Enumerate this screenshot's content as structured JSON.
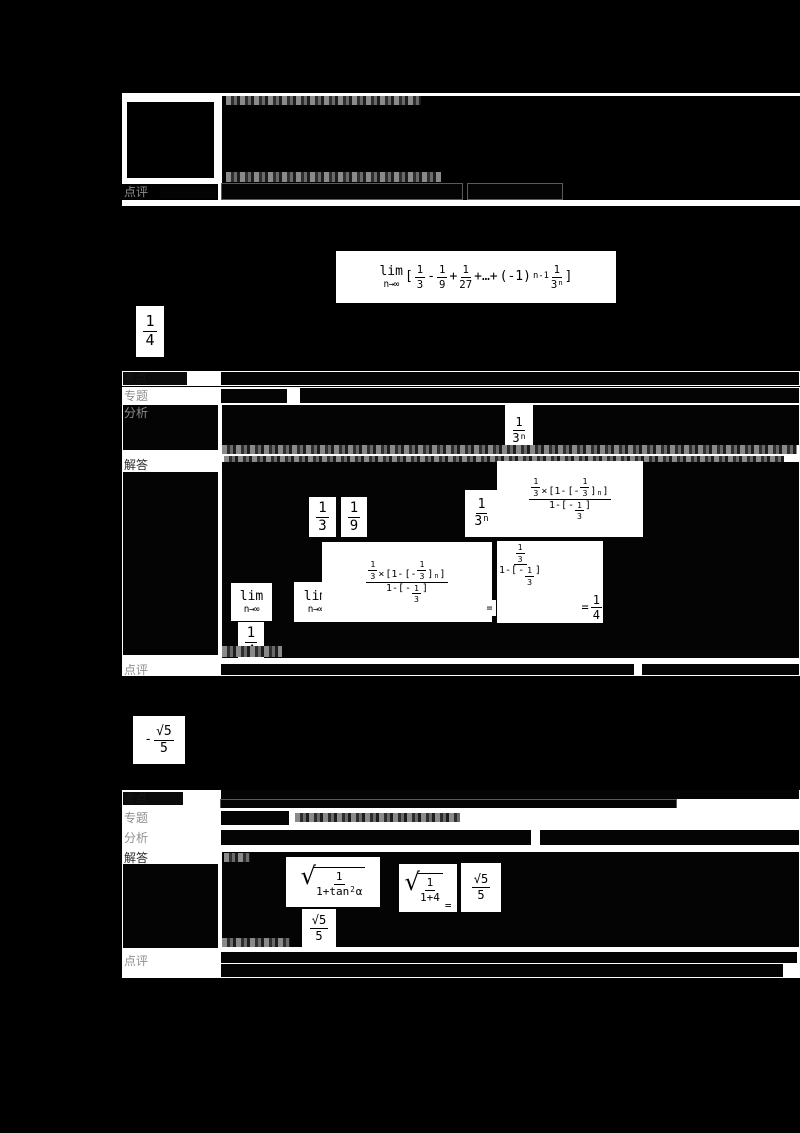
{
  "document": {
    "kind": "scanned Chinese math exam solution page",
    "colors": {
      "background": "#000000",
      "paper": "#ffffff",
      "ink": "#000000",
      "ghost_text": "#8a8a8a"
    }
  },
  "labels": {
    "kaodian": "考点",
    "zhuanti": "专题",
    "fenxi": "分析",
    "jieda": "解答",
    "dianping": "点评"
  },
  "tokens": {
    "lim": "lim",
    "lim_sub": "n→∞",
    "open": "[",
    "close": "]",
    "one": "1",
    "three": "3",
    "four": "4",
    "five": "5",
    "nine": "9",
    "twenty_seven": "27",
    "minus": "-",
    "plus": "+",
    "times": "×",
    "equals": "=",
    "cdots": "+…+",
    "neg_one": "(-1)",
    "exp_n_minus_1": "n-1",
    "exp_n": "n",
    "open_one_minus": "[1-",
    "open_neg": "[-",
    "one_minus_open": "1-[",
    "neg": "-",
    "radical": "√",
    "sqrt5": "√5",
    "one_plus_tan": "1+tan",
    "two": "2",
    "alpha": "α",
    "one_plus_four": "1+4"
  },
  "formulas": {
    "problem_limit": "lim_{n→∞}[1/3 - 1/9 + 1/27 +…+ (-1)^(n-1)·(1/3^n)]",
    "answer_1": "1/4",
    "analysis_term": "1/3^n",
    "geometric_sum": "(1/3)×[1-(-1/3)^n] / (1-(-1/3))",
    "limit_evaluation": "lim_{n→∞} (1/3)×[1-(-1/3)^n]/(1-(-1/3)) = (1/3)/(1-(-1/3)) = 1/4",
    "answer_2": "-√5/5",
    "trig_evaluation": "√(1/(1+tan²α)) = √(1/(1+4)) = √5/5"
  }
}
